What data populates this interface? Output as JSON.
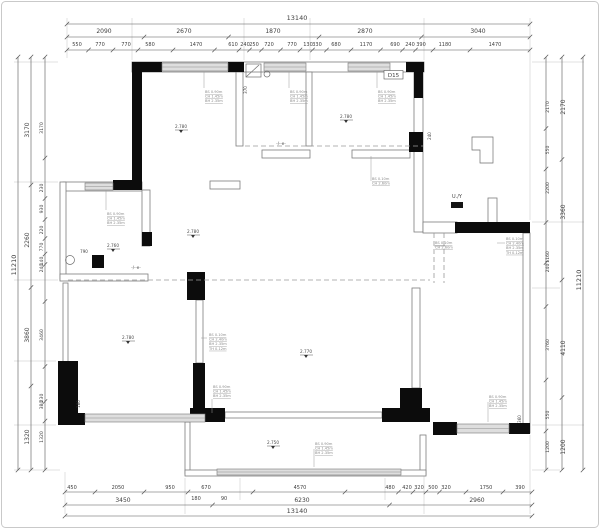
{
  "drawing": {
    "type_label": "floor-plan"
  },
  "dims": {
    "top": {
      "total": "13140",
      "row2": [
        "2090",
        "2670",
        "1870",
        "2870",
        "3040"
      ],
      "row3": [
        "550",
        "770",
        "770",
        "580",
        "1470",
        "610",
        "240",
        "250",
        "720",
        "770",
        "130",
        "330",
        "680",
        "1170",
        "690",
        "240",
        "390",
        "1180",
        "1470"
      ]
    },
    "bottom": {
      "rowA": [
        "450",
        "2050",
        "950",
        "670",
        "4570",
        "480",
        "420",
        "320",
        "500",
        "320",
        "1750",
        "390"
      ],
      "sub": [
        "180",
        "90"
      ],
      "rowB": [
        "3450",
        "6230",
        "2960"
      ],
      "total": "13140"
    },
    "left": {
      "total": "11210",
      "mid": [
        "3170",
        "2260",
        "3860",
        "1320"
      ],
      "inner": [
        "3170",
        "230",
        "930",
        "220",
        "770",
        "140",
        "240",
        "3460",
        "230",
        "380",
        "1320"
      ]
    },
    "right": {
      "inner": [
        "2170",
        "550",
        "2200",
        "1160",
        "240",
        "3760",
        "550",
        "1200"
      ],
      "mid": [
        "2170",
        "3360",
        "4110",
        "1200"
      ],
      "total": "11210"
    }
  },
  "plan": {
    "door_tag": "D15",
    "panel_tag": "U./Y",
    "elevations": [
      "2.780",
      "2.780",
      "2.760",
      "2.780",
      "2.780",
      "2.770",
      "2.750"
    ],
    "window_labels": {
      "l2": [
        "BS 0.10m",
        "CH 2.60m"
      ],
      "l3": [
        "BS 0.90m",
        "CH 1.45m",
        "BH 2.35m"
      ],
      "l4": [
        "BS 0.10m",
        "CH 2.40m",
        "BH 2.35m",
        "TH 0.12m"
      ]
    },
    "small_dims": {
      "d790": "790",
      "d370": "370",
      "d240": "240",
      "d180": "180",
      "d360": "360"
    },
    "open_marks": [
      "-/-·e-",
      "-/-·e-"
    ]
  }
}
